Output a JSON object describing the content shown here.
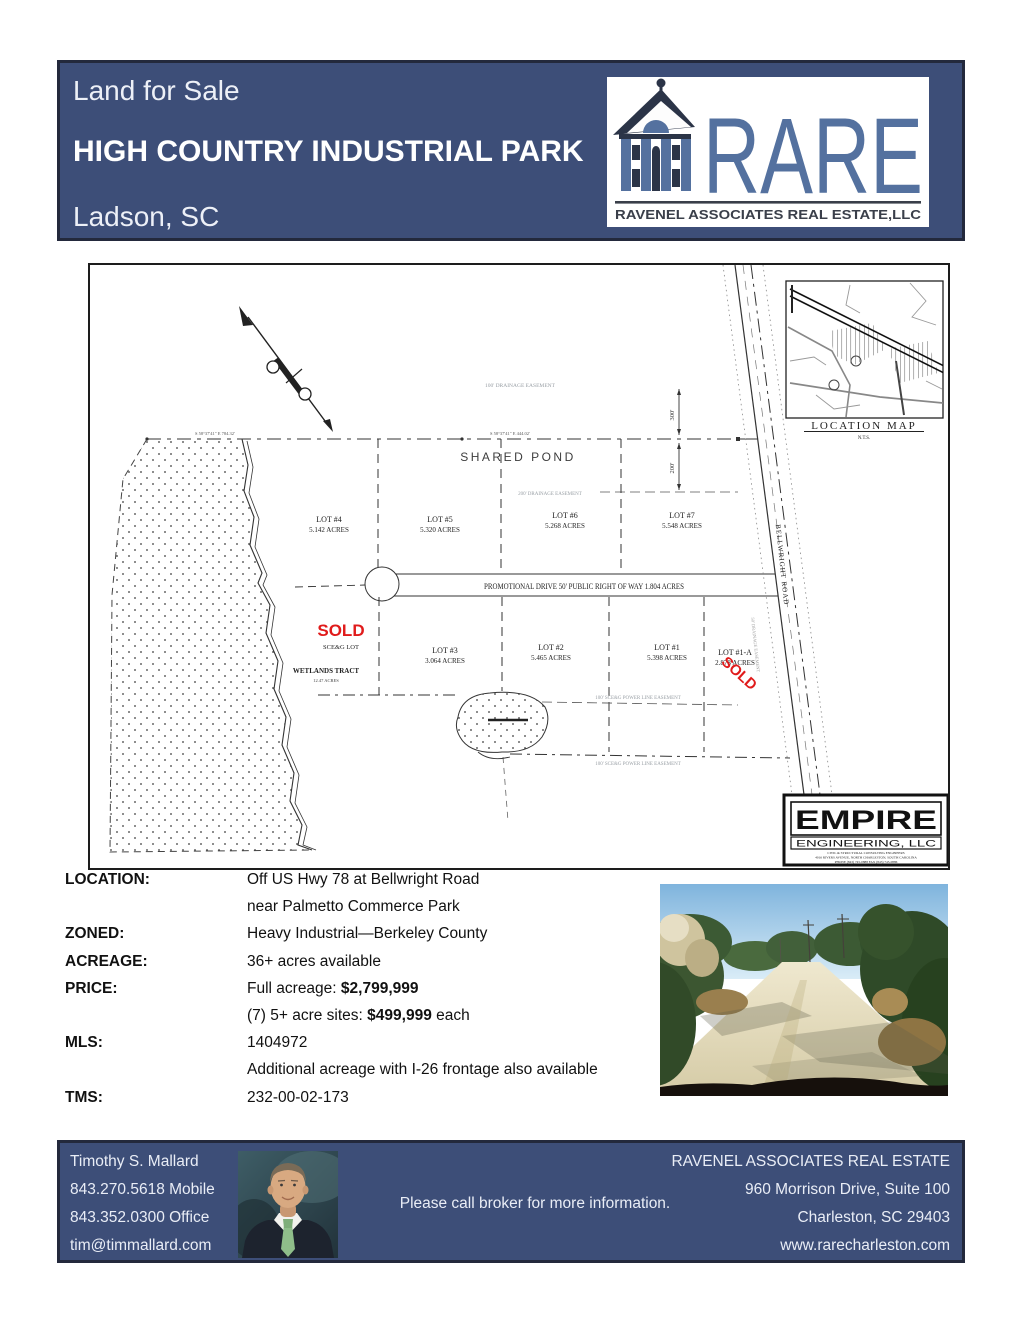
{
  "header": {
    "sale_label": "Land for Sale",
    "title": "HIGH COUNTRY INDUSTRIAL PARK",
    "city": "Ladson, SC"
  },
  "logo": {
    "acronym": "RARE",
    "company": "RAVENEL ASSOCIATES REAL ESTATE,LLC"
  },
  "colors": {
    "navy": "#3D4E78",
    "logo_blue": "#54719F",
    "sold_red": "#E01B1B"
  },
  "plat": {
    "shared_pond": "SHARED POND",
    "wetlands": "WETLANDS TRACT",
    "wetlands_sub": "12.47 ACRES",
    "bearing_left": "S 58°37'41\" E   784.32'",
    "bearing_right": "S 58°37'41\" E   444.02'",
    "dim_top": "300'",
    "dim_bottom": "200'",
    "easement_drainage_100": "100' DRAINAGE EASEMENT",
    "easement_drainage_200": "200' DRAINAGE EASEMENT",
    "easement_power": "100' SCE&G POWER LINE EASEMENT",
    "road_label": "PROMOTIONAL DRIVE    50' PUBLIC RIGHT OF WAY   1.804 ACRES",
    "bellwright": "BELLWRIGHT ROAD",
    "bellwright_easement": "50' DRAINAGE EASEMENT",
    "sold": "SOLD",
    "sceg_lot": "SCE&G LOT",
    "lots_top": [
      {
        "name": "LOT #4",
        "acres": "5.142 ACRES"
      },
      {
        "name": "LOT #5",
        "acres": "5.320 ACRES"
      },
      {
        "name": "LOT #6",
        "acres": "5.268 ACRES"
      },
      {
        "name": "LOT #7",
        "acres": "5.548 ACRES"
      }
    ],
    "lots_bottom": [
      {
        "name": "LOT #3",
        "acres": "3.064 ACRES"
      },
      {
        "name": "LOT #2",
        "acres": "5.465 ACRES"
      },
      {
        "name": "LOT #1",
        "acres": "5.398 ACRES"
      },
      {
        "name": "LOT #1-A",
        "acres": "2.878 ACRES"
      }
    ],
    "location_map": {
      "title": "LOCATION MAP",
      "scale": "N.T.S."
    },
    "empire": {
      "name": "EMPIRE",
      "division": "ENGINEERING,  LLC",
      "line1": "CIVIL & STRUCTURAL CONSULTING ENGINEERS",
      "line2": "4016 RIVERS AVENUE, NORTH CHARLESTON, SOUTH CAROLINA",
      "line3": "PHONE (843) 745-0888      FAX (843) 745-0886"
    }
  },
  "details": {
    "rows": [
      {
        "label": "LOCATION:",
        "pre": "Off US Hwy 78 at Bellwright Road",
        "bold": "",
        "post": ""
      },
      {
        "label": "",
        "pre": "near Palmetto Commerce Park",
        "bold": "",
        "post": ""
      },
      {
        "label": "ZONED:",
        "pre": "Heavy Industrial—Berkeley County",
        "bold": "",
        "post": ""
      },
      {
        "label": "ACREAGE:",
        "pre": "36+ acres available",
        "bold": "",
        "post": ""
      },
      {
        "label": "PRICE:",
        "pre": "Full acreage: ",
        "bold": "$2,799,999",
        "post": ""
      },
      {
        "label": "",
        "pre": "(7) 5+ acre sites: ",
        "bold": "$499,999",
        "post": " each"
      },
      {
        "label": "MLS:",
        "pre": "1404972",
        "bold": "",
        "post": ""
      },
      {
        "label": "",
        "pre": "Additional acreage with I-26 frontage also available",
        "bold": "",
        "post": ""
      },
      {
        "label": "TMS:",
        "pre": "232-00-02-173",
        "bold": "",
        "post": ""
      }
    ]
  },
  "footer": {
    "agent": {
      "name": "Timothy S. Mallard",
      "mobile": "843.270.5618 Mobile",
      "office": "843.352.0300 Office",
      "email": "tim@timmallard.com"
    },
    "note": "Please call broker for more information.",
    "office_block": {
      "company": "RAVENEL ASSOCIATES REAL ESTATE",
      "address1": "960 Morrison Drive, Suite 100",
      "address2": "Charleston, SC 29403",
      "website": "www.rarecharleston.com"
    }
  }
}
